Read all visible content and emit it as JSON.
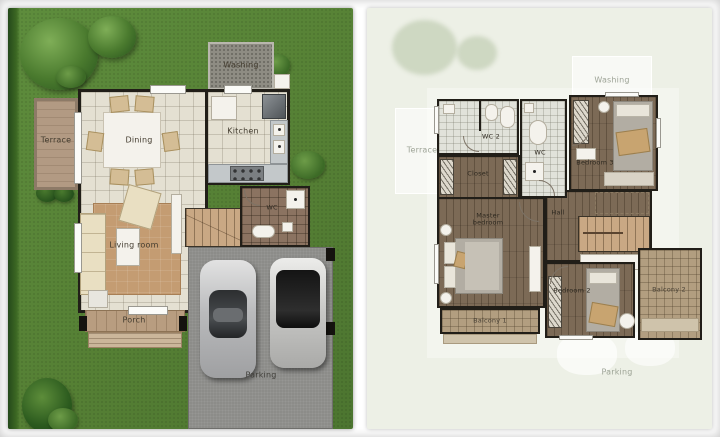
{
  "first_floor": {
    "washing": "Washing",
    "terrace": "Terrace",
    "dining": "Dining",
    "kitchen": "Kitchen",
    "wc": "WC",
    "living_room": "Living room",
    "porch": "Porch",
    "parking": "Parking"
  },
  "second_floor": {
    "wc2": "WC 2",
    "wc": "WC",
    "closet": "Closet",
    "bedroom3": "Bedroom 3",
    "master_line1": "Master",
    "master_line2": "bedroom",
    "hall": "Hall",
    "bedroom2": "Bedroom 2",
    "balcony1": "Balcony 1",
    "balcony2": "Balcony 2",
    "ghost_terrace": "Terrace",
    "ghost_washing": "Washing",
    "ghost_parking": "Parking"
  },
  "colors": {
    "grass": "#5e8d3d",
    "bg_right": "#edf0e6",
    "floor_tile": "#e4e0d2",
    "bath_tile": "#e1e2da",
    "wood": "#7c6a56",
    "wall": "#211e18",
    "terrace": "#b29a83",
    "parking": "#8c8c89",
    "balcony": "#b29e80",
    "stairs": "#c9a884",
    "rug": "#c49c72",
    "sofa": "#e9dfc2",
    "counter": "#c3c8ca",
    "pad": "#8e8c83",
    "blanket": "#c8a470"
  }
}
